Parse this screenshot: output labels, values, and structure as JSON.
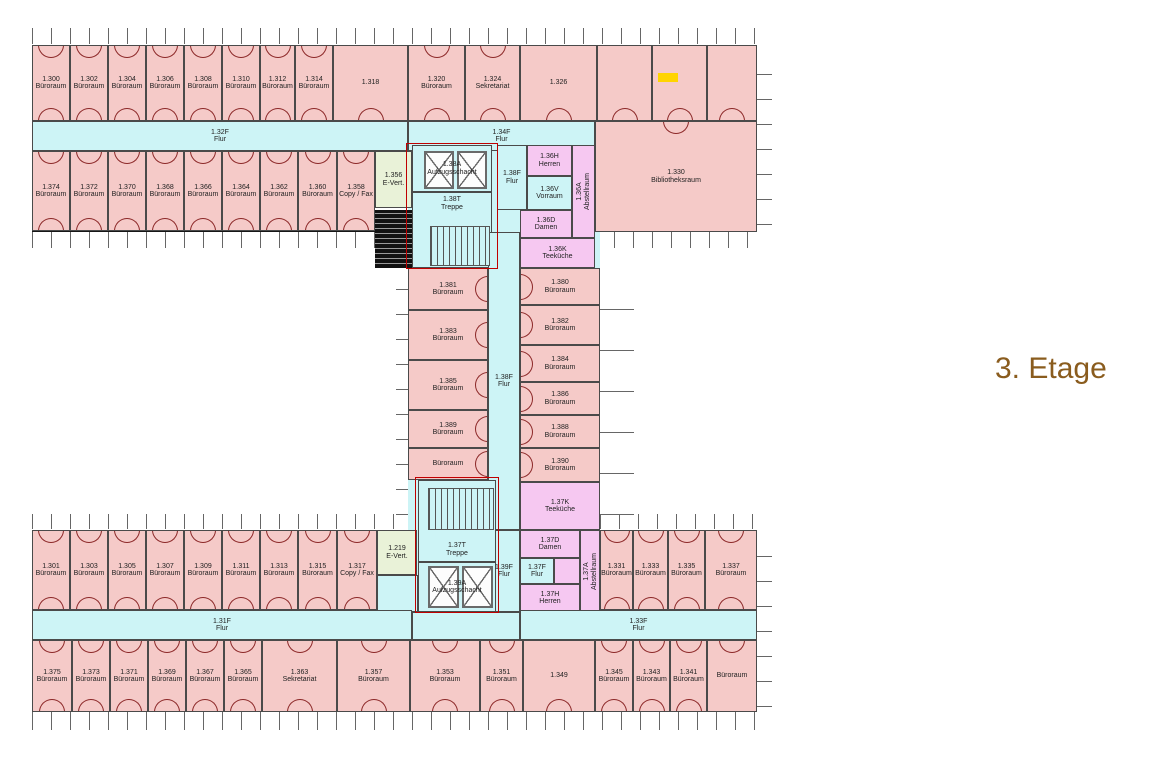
{
  "title": {
    "text": "3. Etage",
    "color": "#8a5c1e"
  },
  "palette": {
    "office": "#f5cac8",
    "corridor": "#cdf4f6",
    "wc": "#f6c8f1",
    "evert": "#e9f2d8",
    "wall": "#4a4a4a",
    "outer_wall": "#161616",
    "door_arc": "#8b2727",
    "hatch": "#111111",
    "marker": "#ffd400",
    "fire_line": "#c00000",
    "tick": "#666666",
    "label": "#222222"
  },
  "wings": [
    {
      "x": 32,
      "y": 45,
      "w": 725,
      "h": 187
    },
    {
      "x": 408,
      "y": 232,
      "w": 192,
      "h": 298
    },
    {
      "x": 32,
      "y": 530,
      "w": 725,
      "h": 182
    }
  ],
  "bases": [
    {
      "x": 408,
      "y": 121,
      "w": 190,
      "h": 147
    },
    {
      "x": 408,
      "y": 232,
      "w": 192,
      "h": 298
    },
    {
      "x": 377,
      "y": 530,
      "w": 143,
      "h": 85
    }
  ],
  "ticks": [
    {
      "x": 32,
      "y": 28,
      "w": 725,
      "h": 16,
      "d": "v"
    },
    {
      "x": 32,
      "y": 232,
      "w": 376,
      "h": 16,
      "d": "v"
    },
    {
      "x": 595,
      "y": 232,
      "w": 162,
      "h": 16,
      "d": "v"
    },
    {
      "x": 32,
      "y": 514,
      "w": 376,
      "h": 15,
      "d": "v"
    },
    {
      "x": 600,
      "y": 514,
      "w": 157,
      "h": 15,
      "d": "v"
    },
    {
      "x": 32,
      "y": 712,
      "w": 725,
      "h": 18,
      "d": "v"
    },
    {
      "x": 757,
      "y": 50,
      "w": 15,
      "h": 175,
      "d": "h"
    },
    {
      "x": 757,
      "y": 535,
      "w": 15,
      "h": 172,
      "d": "h"
    },
    {
      "x": 396,
      "y": 270,
      "w": 12,
      "h": 245,
      "d": "h"
    },
    {
      "x": 600,
      "y": 270,
      "w": 34,
      "h": 245,
      "d": "hl"
    }
  ],
  "red_zones": [
    {
      "x": 406,
      "y": 143,
      "w": 92,
      "h": 126
    },
    {
      "x": 415,
      "y": 477,
      "w": 84,
      "h": 136
    }
  ],
  "shafts": [
    {
      "x": 424,
      "y": 151,
      "w": 30,
      "h": 38
    },
    {
      "x": 457,
      "y": 151,
      "w": 30,
      "h": 38
    },
    {
      "x": 428,
      "y": 566,
      "w": 31,
      "h": 42
    },
    {
      "x": 462,
      "y": 566,
      "w": 31,
      "h": 42
    }
  ],
  "stairs": [
    {
      "x": 430,
      "y": 226,
      "w": 60,
      "h": 40
    },
    {
      "x": 428,
      "y": 488,
      "w": 66,
      "h": 42
    }
  ],
  "hatches": [
    {
      "x": 375,
      "y": 210,
      "w": 37,
      "h": 58
    }
  ],
  "marker": {
    "x": 658,
    "y": 73,
    "w": 20,
    "h": 9
  },
  "rooms": [
    {
      "n": "1.300",
      "l": "Büroraum",
      "k": "office",
      "x": 32,
      "y": 45,
      "w": 38,
      "h": 76,
      "a": "tb"
    },
    {
      "n": "1.302",
      "l": "Büroraum",
      "k": "office",
      "x": 70,
      "y": 45,
      "w": 38,
      "h": 76,
      "a": "tb"
    },
    {
      "n": "1.304",
      "l": "Büroraum",
      "k": "office",
      "x": 108,
      "y": 45,
      "w": 38,
      "h": 76,
      "a": "tb"
    },
    {
      "n": "1.306",
      "l": "Büroraum",
      "k": "office",
      "x": 146,
      "y": 45,
      "w": 38,
      "h": 76,
      "a": "tb"
    },
    {
      "n": "1.308",
      "l": "Büroraum",
      "k": "office",
      "x": 184,
      "y": 45,
      "w": 38,
      "h": 76,
      "a": "tb"
    },
    {
      "n": "1.310",
      "l": "Büroraum",
      "k": "office",
      "x": 222,
      "y": 45,
      "w": 38,
      "h": 76,
      "a": "tb"
    },
    {
      "n": "1.312",
      "l": "Büroraum",
      "k": "office",
      "x": 260,
      "y": 45,
      "w": 35,
      "h": 76,
      "a": "tb"
    },
    {
      "n": "1.314",
      "l": "Büroraum",
      "k": "office",
      "x": 295,
      "y": 45,
      "w": 38,
      "h": 76,
      "a": "tb"
    },
    {
      "n": "1.318",
      "l": "",
      "k": "office",
      "x": 333,
      "y": 45,
      "w": 75,
      "h": 76,
      "a": "b"
    },
    {
      "n": "1.320",
      "l": "Büroraum",
      "k": "office",
      "x": 408,
      "y": 45,
      "w": 57,
      "h": 76,
      "a": "tb"
    },
    {
      "n": "1.324",
      "l": "Sekretariat",
      "k": "office",
      "x": 465,
      "y": 45,
      "w": 55,
      "h": 76,
      "a": "tb"
    },
    {
      "n": "1.326",
      "l": "",
      "k": "office",
      "x": 520,
      "y": 45,
      "w": 77,
      "h": 76,
      "a": "b"
    },
    {
      "n": "",
      "l": "",
      "k": "office",
      "x": 597,
      "y": 45,
      "w": 55,
      "h": 76,
      "a": "b"
    },
    {
      "n": "",
      "l": "",
      "k": "office",
      "x": 652,
      "y": 45,
      "w": 55,
      "h": 76,
      "a": "b"
    },
    {
      "n": "",
      "l": "",
      "k": "office",
      "x": 707,
      "y": 45,
      "w": 50,
      "h": 76,
      "a": "b"
    },
    {
      "n": "1.32F",
      "l": "Flur",
      "k": "corr",
      "x": 32,
      "y": 121,
      "w": 376,
      "h": 30
    },
    {
      "n": "1.34F",
      "l": "Flur",
      "k": "corr",
      "x": 408,
      "y": 121,
      "w": 187,
      "h": 30
    },
    {
      "n": "1.374",
      "l": "Büroraum",
      "k": "office",
      "x": 32,
      "y": 151,
      "w": 38,
      "h": 80,
      "a": "tb"
    },
    {
      "n": "1.372",
      "l": "Büroraum",
      "k": "office",
      "x": 70,
      "y": 151,
      "w": 38,
      "h": 80,
      "a": "tb"
    },
    {
      "n": "1.370",
      "l": "Büroraum",
      "k": "office",
      "x": 108,
      "y": 151,
      "w": 38,
      "h": 80,
      "a": "tb"
    },
    {
      "n": "1.368",
      "l": "Büroraum",
      "k": "office",
      "x": 146,
      "y": 151,
      "w": 38,
      "h": 80,
      "a": "tb"
    },
    {
      "n": "1.366",
      "l": "Büroraum",
      "k": "office",
      "x": 184,
      "y": 151,
      "w": 38,
      "h": 80,
      "a": "tb"
    },
    {
      "n": "1.364",
      "l": "Büroraum",
      "k": "office",
      "x": 222,
      "y": 151,
      "w": 38,
      "h": 80,
      "a": "tb"
    },
    {
      "n": "1.362",
      "l": "Büroraum",
      "k": "office",
      "x": 260,
      "y": 151,
      "w": 38,
      "h": 80,
      "a": "tb"
    },
    {
      "n": "1.360",
      "l": "Büroraum",
      "k": "office",
      "x": 298,
      "y": 151,
      "w": 39,
      "h": 80,
      "a": "tb"
    },
    {
      "n": "1.358",
      "l": "Copy / Fax",
      "k": "office",
      "x": 337,
      "y": 151,
      "w": 38,
      "h": 80,
      "a": "tb"
    },
    {
      "n": "1.356",
      "l": "E-Vert.",
      "k": "evert",
      "x": 375,
      "y": 151,
      "w": 37,
      "h": 57
    },
    {
      "n": "1.330",
      "l": "Bibliotheksraum",
      "k": "office",
      "x": 595,
      "y": 121,
      "w": 162,
      "h": 111,
      "a": "t"
    },
    {
      "n": "1.38A",
      "l": "Aufzugsschacht",
      "k": "core",
      "x": 412,
      "y": 145,
      "w": 80,
      "h": 47
    },
    {
      "n": "1.38T",
      "l": "Treppe",
      "k": "core",
      "x": 412,
      "y": 192,
      "w": 80,
      "h": 76,
      "lp": "t"
    },
    {
      "n": "1.38F",
      "l": "Flur",
      "k": "corr",
      "x": 497,
      "y": 145,
      "w": 30,
      "h": 65
    },
    {
      "n": "1.36H",
      "l": "Herren",
      "k": "wc",
      "x": 527,
      "y": 145,
      "w": 45,
      "h": 31
    },
    {
      "n": "1.36V",
      "l": "Vorraum",
      "k": "corr",
      "x": 527,
      "y": 176,
      "w": 45,
      "h": 34
    },
    {
      "n": "1.36A",
      "l": "Abstellraum",
      "k": "wc",
      "x": 572,
      "y": 145,
      "w": 23,
      "h": 93,
      "rot": true
    },
    {
      "n": "1.36D",
      "l": "Damen",
      "k": "wc",
      "x": 520,
      "y": 210,
      "w": 52,
      "h": 28
    },
    {
      "n": "1.36K",
      "l": "Teeküche",
      "k": "wc",
      "x": 520,
      "y": 238,
      "w": 75,
      "h": 30
    },
    {
      "n": "1.38F",
      "l": "Flur",
      "k": "corr",
      "x": 488,
      "y": 232,
      "w": 32,
      "h": 298
    },
    {
      "n": "1.39F",
      "l": "Flur",
      "k": "corr",
      "x": 488,
      "y": 530,
      "w": 32,
      "h": 82
    },
    {
      "n": "1.381",
      "l": "Büroraum",
      "k": "office",
      "x": 408,
      "y": 268,
      "w": 80,
      "h": 42,
      "a": "r"
    },
    {
      "n": "1.383",
      "l": "Büroraum",
      "k": "office",
      "x": 408,
      "y": 310,
      "w": 80,
      "h": 50,
      "a": "r"
    },
    {
      "n": "1.385",
      "l": "Büroraum",
      "k": "office",
      "x": 408,
      "y": 360,
      "w": 80,
      "h": 50,
      "a": "r"
    },
    {
      "n": "1.389",
      "l": "Büroraum",
      "k": "office",
      "x": 408,
      "y": 410,
      "w": 80,
      "h": 38,
      "a": "r"
    },
    {
      "n": "",
      "l": "Büroraum",
      "k": "office",
      "x": 408,
      "y": 448,
      "w": 80,
      "h": 32,
      "a": "r"
    },
    {
      "n": "1.380",
      "l": "Büroraum",
      "k": "office",
      "x": 520,
      "y": 268,
      "w": 80,
      "h": 37,
      "a": "l"
    },
    {
      "n": "1.382",
      "l": "Büroraum",
      "k": "office",
      "x": 520,
      "y": 305,
      "w": 80,
      "h": 40,
      "a": "l"
    },
    {
      "n": "1.384",
      "l": "Büroraum",
      "k": "office",
      "x": 520,
      "y": 345,
      "w": 80,
      "h": 37,
      "a": "l"
    },
    {
      "n": "1.386",
      "l": "Büroraum",
      "k": "office",
      "x": 520,
      "y": 382,
      "w": 80,
      "h": 33,
      "a": "l"
    },
    {
      "n": "1.388",
      "l": "Büroraum",
      "k": "office",
      "x": 520,
      "y": 415,
      "w": 80,
      "h": 33,
      "a": "l"
    },
    {
      "n": "1.390",
      "l": "Büroraum",
      "k": "office",
      "x": 520,
      "y": 448,
      "w": 80,
      "h": 34,
      "a": "l"
    },
    {
      "n": "1.37K",
      "l": "Teeküche",
      "k": "wc",
      "x": 520,
      "y": 482,
      "w": 80,
      "h": 48
    },
    {
      "n": "1.37T",
      "l": "Treppe",
      "k": "core",
      "x": 418,
      "y": 480,
      "w": 78,
      "h": 82,
      "lp": "b"
    },
    {
      "n": "1.39A",
      "l": "Aufzugsschacht",
      "k": "core",
      "x": 418,
      "y": 562,
      "w": 78,
      "h": 50
    },
    {
      "n": "1.219",
      "l": "E-Vert.",
      "k": "evert",
      "x": 377,
      "y": 530,
      "w": 40,
      "h": 45
    },
    {
      "n": "",
      "l": "",
      "k": "corr",
      "x": 377,
      "y": 575,
      "w": 41,
      "h": 37
    },
    {
      "n": "",
      "l": "",
      "k": "corr",
      "x": 412,
      "y": 612,
      "w": 108,
      "h": 28
    },
    {
      "n": "1.37D",
      "l": "Damen",
      "k": "wc",
      "x": 520,
      "y": 530,
      "w": 60,
      "h": 28
    },
    {
      "n": "1.37F",
      "l": "Flur",
      "k": "corr",
      "x": 520,
      "y": 558,
      "w": 34,
      "h": 26
    },
    {
      "n": "",
      "l": "",
      "k": "wc",
      "x": 554,
      "y": 558,
      "w": 26,
      "h": 26
    },
    {
      "n": "1.37H",
      "l": "Herren",
      "k": "wc",
      "x": 520,
      "y": 584,
      "w": 60,
      "h": 28
    },
    {
      "n": "1.37A",
      "l": "Abstellraum",
      "k": "wc",
      "x": 580,
      "y": 530,
      "w": 20,
      "h": 82,
      "rot": true
    },
    {
      "n": "1.301",
      "l": "Büroraum",
      "k": "office",
      "x": 32,
      "y": 530,
      "w": 38,
      "h": 80,
      "a": "tb"
    },
    {
      "n": "1.303",
      "l": "Büroraum",
      "k": "office",
      "x": 70,
      "y": 530,
      "w": 38,
      "h": 80,
      "a": "tb"
    },
    {
      "n": "1.305",
      "l": "Büroraum",
      "k": "office",
      "x": 108,
      "y": 530,
      "w": 38,
      "h": 80,
      "a": "tb"
    },
    {
      "n": "1.307",
      "l": "Büroraum",
      "k": "office",
      "x": 146,
      "y": 530,
      "w": 38,
      "h": 80,
      "a": "tb"
    },
    {
      "n": "1.309",
      "l": "Büroraum",
      "k": "office",
      "x": 184,
      "y": 530,
      "w": 38,
      "h": 80,
      "a": "tb"
    },
    {
      "n": "1.311",
      "l": "Büroraum",
      "k": "office",
      "x": 222,
      "y": 530,
      "w": 38,
      "h": 80,
      "a": "tb"
    },
    {
      "n": "1.313",
      "l": "Büroraum",
      "k": "office",
      "x": 260,
      "y": 530,
      "w": 38,
      "h": 80,
      "a": "tb"
    },
    {
      "n": "1.315",
      "l": "Büroraum",
      "k": "office",
      "x": 298,
      "y": 530,
      "w": 39,
      "h": 80,
      "a": "tb"
    },
    {
      "n": "1.317",
      "l": "Copy / Fax",
      "k": "office",
      "x": 337,
      "y": 530,
      "w": 40,
      "h": 80,
      "a": "tb"
    },
    {
      "n": "1.331",
      "l": "Büroraum",
      "k": "office",
      "x": 600,
      "y": 530,
      "w": 33,
      "h": 80,
      "a": "tb"
    },
    {
      "n": "1.333",
      "l": "Büroraum",
      "k": "office",
      "x": 633,
      "y": 530,
      "w": 35,
      "h": 80,
      "a": "tb"
    },
    {
      "n": "1.335",
      "l": "Büroraum",
      "k": "office",
      "x": 668,
      "y": 530,
      "w": 37,
      "h": 80,
      "a": "tb"
    },
    {
      "n": "1.337",
      "l": "Büroraum",
      "k": "office",
      "x": 705,
      "y": 530,
      "w": 52,
      "h": 80,
      "a": "tb"
    },
    {
      "n": "1.31F",
      "l": "Flur",
      "k": "corr",
      "x": 32,
      "y": 610,
      "w": 380,
      "h": 30
    },
    {
      "n": "1.33F",
      "l": "Flur",
      "k": "corr",
      "x": 520,
      "y": 610,
      "w": 237,
      "h": 30
    },
    {
      "n": "1.375",
      "l": "Büroraum",
      "k": "office",
      "x": 32,
      "y": 640,
      "w": 40,
      "h": 72,
      "a": "tb"
    },
    {
      "n": "1.373",
      "l": "Büroraum",
      "k": "office",
      "x": 72,
      "y": 640,
      "w": 38,
      "h": 72,
      "a": "tb"
    },
    {
      "n": "1.371",
      "l": "Büroraum",
      "k": "office",
      "x": 110,
      "y": 640,
      "w": 38,
      "h": 72,
      "a": "tb"
    },
    {
      "n": "1.369",
      "l": "Büroraum",
      "k": "office",
      "x": 148,
      "y": 640,
      "w": 38,
      "h": 72,
      "a": "tb"
    },
    {
      "n": "1.367",
      "l": "Büroraum",
      "k": "office",
      "x": 186,
      "y": 640,
      "w": 38,
      "h": 72,
      "a": "tb"
    },
    {
      "n": "1.365",
      "l": "Büroraum",
      "k": "office",
      "x": 224,
      "y": 640,
      "w": 38,
      "h": 72,
      "a": "tb"
    },
    {
      "n": "1.363",
      "l": "Sekretariat",
      "k": "office",
      "x": 262,
      "y": 640,
      "w": 75,
      "h": 72,
      "a": "tb"
    },
    {
      "n": "1.357",
      "l": "Büroraum",
      "k": "office",
      "x": 337,
      "y": 640,
      "w": 73,
      "h": 72,
      "a": "tb"
    },
    {
      "n": "1.353",
      "l": "Büroraum",
      "k": "office",
      "x": 410,
      "y": 640,
      "w": 70,
      "h": 72,
      "a": "tb"
    },
    {
      "n": "1.351",
      "l": "Büroraum",
      "k": "office",
      "x": 480,
      "y": 640,
      "w": 43,
      "h": 72,
      "a": "tb"
    },
    {
      "n": "1.349",
      "l": "",
      "k": "office",
      "x": 523,
      "y": 640,
      "w": 72,
      "h": 72,
      "a": "b"
    },
    {
      "n": "1.345",
      "l": "Büroraum",
      "k": "office",
      "x": 595,
      "y": 640,
      "w": 38,
      "h": 72,
      "a": "tb"
    },
    {
      "n": "1.343",
      "l": "Büroraum",
      "k": "office",
      "x": 633,
      "y": 640,
      "w": 37,
      "h": 72,
      "a": "tb"
    },
    {
      "n": "1.341",
      "l": "Büroraum",
      "k": "office",
      "x": 670,
      "y": 640,
      "w": 37,
      "h": 72,
      "a": "tb"
    },
    {
      "n": "",
      "l": "Büroraum",
      "k": "office",
      "x": 707,
      "y": 640,
      "w": 50,
      "h": 72,
      "a": "t"
    }
  ]
}
